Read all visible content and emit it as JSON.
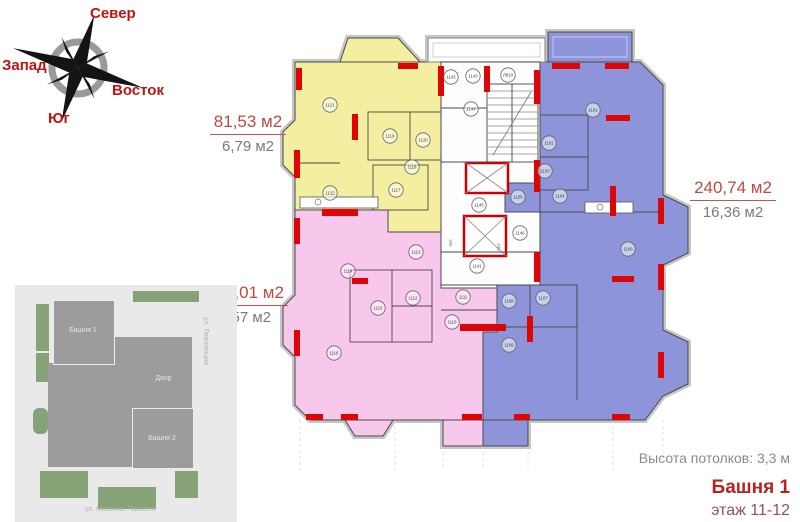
{
  "compass": {
    "north": "Север",
    "west": "Запад",
    "east": "Восток",
    "south": "Юг"
  },
  "apartments": [
    {
      "name": "yellow-apartment",
      "area_total": "81,53 м2",
      "area_secondary": "6,79 м2",
      "fill": "#f4efa0"
    },
    {
      "name": "pink-apartment",
      "area_total": "153,01 м2",
      "area_secondary": "9,57 м2",
      "fill": "#f8c8ec"
    },
    {
      "name": "blue-apartment",
      "area_total": "240,74 м2",
      "area_secondary": "16,36 м2",
      "fill": "#8d94da"
    }
  ],
  "info": {
    "ceiling_height": "Высота потолков: 3,3 м",
    "tower": "Башня 1",
    "floors": "этаж 11-12"
  },
  "site_plan": {
    "tower1_label": "Башня 1",
    "tower2_label": "Башня 2",
    "courtyard_label": "Двор",
    "street_side": "ул. Революции",
    "street_bottom": "ул. Максима Горького"
  },
  "floor_plan": {
    "colors": {
      "yellow": "#f4efa0",
      "pink": "#f8c8ec",
      "blue": "#8d94da",
      "column_red": "#dd0505",
      "elevator_red": "#cc0000",
      "wall_gray": "#c6c6c6"
    },
    "elevator_labels": [
      "№5",
      "№3"
    ],
    "rooms": [
      {
        "label": "1121",
        "x": 330,
        "y": 105,
        "zone": "yellow"
      },
      {
        "label": "1119",
        "x": 390,
        "y": 136,
        "zone": "yellow"
      },
      {
        "label": "1120",
        "x": 423,
        "y": 140,
        "zone": "yellow"
      },
      {
        "label": "1118",
        "x": 412,
        "y": 167,
        "zone": "yellow"
      },
      {
        "label": "1117",
        "x": 396,
        "y": 190,
        "zone": "yellow"
      },
      {
        "label": "1122",
        "x": 330,
        "y": 193,
        "zone": "yellow"
      },
      {
        "label": "1113",
        "x": 416,
        "y": 252,
        "zone": "pink"
      },
      {
        "label": "1114",
        "x": 348,
        "y": 271,
        "zone": "pink"
      },
      {
        "label": "1112",
        "x": 413,
        "y": 298,
        "zone": "pink"
      },
      {
        "label": "1115",
        "x": 378,
        "y": 308,
        "zone": "pink"
      },
      {
        "label": "1116",
        "x": 334,
        "y": 353,
        "zone": "pink"
      },
      {
        "label": "1111",
        "x": 463,
        "y": 297,
        "zone": "pink"
      },
      {
        "label": "1110",
        "x": 452,
        "y": 322,
        "zone": "pink"
      },
      {
        "label": "1101",
        "x": 593,
        "y": 110,
        "zone": "blue"
      },
      {
        "label": "1102",
        "x": 549,
        "y": 143,
        "zone": "blue"
      },
      {
        "label": "1103",
        "x": 545,
        "y": 171,
        "zone": "blue"
      },
      {
        "label": "1105",
        "x": 518,
        "y": 197,
        "zone": "blue"
      },
      {
        "label": "1104",
        "x": 560,
        "y": 196,
        "zone": "blue"
      },
      {
        "label": "1106",
        "x": 628,
        "y": 249,
        "zone": "blue"
      },
      {
        "label": "1108",
        "x": 509,
        "y": 301,
        "zone": "blue"
      },
      {
        "label": "1107",
        "x": 543,
        "y": 298,
        "zone": "blue"
      },
      {
        "label": "1109",
        "x": 509,
        "y": 345,
        "zone": "blue"
      },
      {
        "label": "1142",
        "x": 451,
        "y": 77,
        "zone": "core"
      },
      {
        "label": "1143",
        "x": 473,
        "y": 76,
        "zone": "core"
      },
      {
        "label": "ЛК10",
        "x": 508,
        "y": 75,
        "zone": "core"
      },
      {
        "label": "1144",
        "x": 471,
        "y": 109,
        "zone": "core"
      },
      {
        "label": "1145",
        "x": 479,
        "y": 205,
        "zone": "core"
      },
      {
        "label": "1146",
        "x": 520,
        "y": 233,
        "zone": "core"
      },
      {
        "label": "1141",
        "x": 477,
        "y": 266,
        "zone": "core"
      }
    ]
  }
}
